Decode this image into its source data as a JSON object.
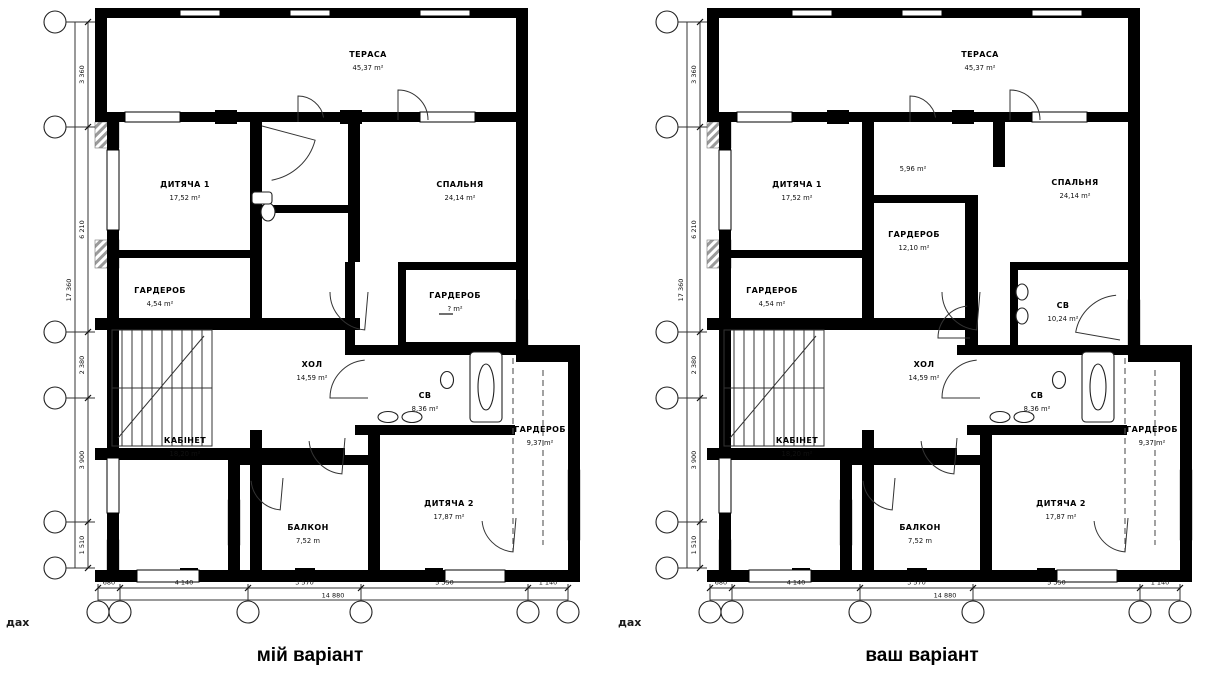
{
  "captions": {
    "left": "мій варіант",
    "right": "ваш варіант"
  },
  "watermark": {
    "text": "дах"
  },
  "colors": {
    "wall": "#000000",
    "hatch": "#999999",
    "line": "#333333",
    "dim": "#111111",
    "background": "#ffffff"
  },
  "dims": {
    "bottom_segments": [
      "680",
      "4 140",
      "3 570",
      "5 350",
      "1 140"
    ],
    "bottom_total": "14 880",
    "left_segments": [
      "3 360",
      "6 210",
      "2 380",
      "3 900",
      "1 510"
    ],
    "left_total": "17 360"
  },
  "axes": {
    "left_cx": 55,
    "bottom_cy": 612,
    "circle_r": 11,
    "left_ys": [
      22,
      127,
      332,
      398,
      522,
      568
    ],
    "bottom_xs": [
      98,
      120,
      248,
      361,
      528,
      568
    ]
  },
  "common": {
    "walls": [
      [
        95,
        8,
        433,
        10
      ],
      [
        95,
        18,
        12,
        96
      ],
      [
        516,
        18,
        12,
        96
      ],
      [
        95,
        112,
        433,
        10
      ],
      [
        107,
        122,
        12,
        448
      ],
      [
        95,
        570,
        485,
        12
      ],
      [
        516,
        122,
        12,
        240
      ],
      [
        568,
        362,
        12,
        220
      ],
      [
        516,
        350,
        64,
        12
      ],
      [
        250,
        122,
        12,
        198
      ],
      [
        107,
        250,
        145,
        8
      ],
      [
        95,
        318,
        265,
        12
      ],
      [
        95,
        448,
        250,
        12
      ],
      [
        250,
        430,
        12,
        140
      ],
      [
        228,
        455,
        152,
        10
      ],
      [
        228,
        465,
        12,
        110
      ],
      [
        368,
        430,
        12,
        140
      ],
      [
        345,
        345,
        235,
        10
      ],
      [
        355,
        425,
        160,
        10
      ]
    ],
    "windows": [
      [
        125,
        112,
        55,
        10
      ],
      [
        420,
        112,
        55,
        10
      ],
      [
        137,
        570,
        62,
        12
      ],
      [
        445,
        570,
        60,
        12
      ],
      [
        107,
        150,
        12,
        80
      ],
      [
        107,
        458,
        12,
        55
      ],
      [
        180,
        10,
        40,
        6
      ],
      [
        290,
        10,
        40,
        6
      ],
      [
        420,
        10,
        50,
        6
      ]
    ],
    "piers": [
      [
        215,
        110,
        22,
        14
      ],
      [
        340,
        110,
        22,
        14
      ],
      [
        180,
        568,
        18,
        14
      ],
      [
        295,
        568,
        20,
        14
      ],
      [
        425,
        568,
        18,
        14
      ]
    ],
    "hatch": [
      [
        95,
        122,
        24,
        26
      ],
      [
        95,
        240,
        24,
        28
      ],
      [
        107,
        540,
        12,
        30
      ],
      [
        228,
        500,
        12,
        45
      ],
      [
        516,
        300,
        12,
        55
      ],
      [
        568,
        470,
        12,
        70
      ]
    ],
    "dashes": [
      [
        513,
        358,
        513,
        552
      ],
      [
        543,
        370,
        543,
        545
      ]
    ],
    "arcs": [
      [
        398,
        120,
        30,
        270,
        360
      ],
      [
        368,
        292,
        38,
        95,
        180
      ],
      [
        368,
        398,
        38,
        180,
        265
      ],
      [
        345,
        438,
        36,
        95,
        175
      ],
      [
        516,
        518,
        34,
        95,
        175
      ],
      [
        283,
        478,
        32,
        95,
        175
      ],
      [
        298,
        122,
        26,
        270,
        350
      ]
    ],
    "fixtures": [
      {
        "t": "e",
        "x": 388,
        "y": 417,
        "w": 20,
        "h": 11
      },
      {
        "t": "e",
        "x": 412,
        "y": 417,
        "w": 20,
        "h": 11
      },
      {
        "t": "e",
        "x": 447,
        "y": 380,
        "w": 13,
        "h": 17
      },
      {
        "t": "r",
        "x": 470,
        "y": 352,
        "w": 32,
        "h": 70
      },
      {
        "t": "e",
        "x": 486,
        "y": 387,
        "w": 16,
        "h": 46
      }
    ],
    "stairs": {
      "x": 112,
      "y": 330,
      "w": 100,
      "h": 116,
      "steps": 11
    }
  },
  "plans": [
    {
      "name": "left-plan",
      "dx": 0,
      "rooms": [
        {
          "label": "ТЕРАСА",
          "area": "45,37 m²",
          "x": 368,
          "y": 57
        },
        {
          "label": "ДИТЯЧА 1",
          "area": "17,52 m²",
          "x": 185,
          "y": 187
        },
        {
          "label": "СПАЛЬНЯ",
          "area": "24,14 m²",
          "x": 460,
          "y": 187
        },
        {
          "label": "ГАРДЕРОБ",
          "area": "4,54 m²",
          "x": 160,
          "y": 293
        },
        {
          "label": "ГАРДЕРОБ",
          "area": "?  m²",
          "x": 455,
          "y": 298,
          "u": true
        },
        {
          "label": "ХОЛ",
          "area": "14,59 m²",
          "x": 312,
          "y": 367
        },
        {
          "label": "СВ",
          "area": "8,36 m²",
          "x": 425,
          "y": 398
        },
        {
          "label": "КАБІНЕТ",
          "area": "18,20 m²",
          "x": 185,
          "y": 443
        },
        {
          "label": "ГАРДЕРОБ",
          "area": "9,37 m²",
          "x": 540,
          "y": 432
        },
        {
          "label": "БАЛКОН",
          "area": "7,52 m",
          "x": 308,
          "y": 530
        },
        {
          "label": "ДИТЯЧА 2",
          "area": "17,87 m²",
          "x": 449,
          "y": 506
        }
      ],
      "extra_walls": [
        [
          348,
          122,
          12,
          140
        ],
        [
          398,
          262,
          130,
          8
        ],
        [
          398,
          262,
          8,
          88
        ],
        [
          398,
          342,
          130,
          8
        ],
        [
          345,
          262,
          10,
          93
        ],
        [
          258,
          205,
          90,
          8
        ]
      ],
      "extra_arcs": [
        [
          262,
          126,
          55,
          15,
          80
        ]
      ],
      "extra_fixtures": [
        {
          "t": "e",
          "x": 268,
          "y": 212,
          "w": 14,
          "h": 18
        },
        {
          "t": "r",
          "x": 252,
          "y": 192,
          "w": 20,
          "h": 12
        }
      ]
    },
    {
      "name": "right-plan",
      "dx": 612,
      "rooms": [
        {
          "label": "ТЕРАСА",
          "area": "45,37 m²",
          "x": 980,
          "y": 57
        },
        {
          "label": "ДИТЯЧА 1",
          "area": "17,52 m²",
          "x": 797,
          "y": 187
        },
        {
          "label": "",
          "area": "5,96 m²",
          "x": 913,
          "y": 158
        },
        {
          "label": "СПАЛЬНЯ",
          "area": "24,14 m²",
          "x": 1075,
          "y": 185
        },
        {
          "label": "ГАРДЕРОБ",
          "area": "4,54 m²",
          "x": 772,
          "y": 293
        },
        {
          "label": "ГАРДЕРОБ",
          "area": "12,10 m²",
          "x": 914,
          "y": 237
        },
        {
          "label": "СВ",
          "area": "10,24 m²",
          "x": 1063,
          "y": 308
        },
        {
          "label": "ХОЛ",
          "area": "14,59 m²",
          "x": 924,
          "y": 367
        },
        {
          "label": "СВ",
          "area": "8,36 m²",
          "x": 1037,
          "y": 398
        },
        {
          "label": "КАБІНЕТ",
          "area": "18,20 m²",
          "x": 797,
          "y": 443
        },
        {
          "label": "ГАРДЕРОБ",
          "area": "9,37 m²",
          "x": 1152,
          "y": 432
        },
        {
          "label": "БАЛКОН",
          "area": "7,52 m",
          "x": 920,
          "y": 530
        },
        {
          "label": "ДИТЯЧА 2",
          "area": "17,87 m²",
          "x": 1061,
          "y": 506
        }
      ],
      "extra_walls": [
        [
          868,
          195,
          110,
          8
        ],
        [
          965,
          195,
          13,
          160
        ],
        [
          993,
          122,
          12,
          45
        ],
        [
          1010,
          262,
          130,
          8
        ],
        [
          1010,
          262,
          8,
          88
        ]
      ],
      "extra_arcs": [
        [
          970,
          338,
          32,
          180,
          265
        ],
        [
          1120,
          340,
          45,
          190,
          265
        ]
      ],
      "extra_fixtures": [
        {
          "t": "e",
          "x": 1022,
          "y": 292,
          "w": 12,
          "h": 16
        },
        {
          "t": "e",
          "x": 1022,
          "y": 316,
          "w": 12,
          "h": 16
        }
      ]
    }
  ]
}
